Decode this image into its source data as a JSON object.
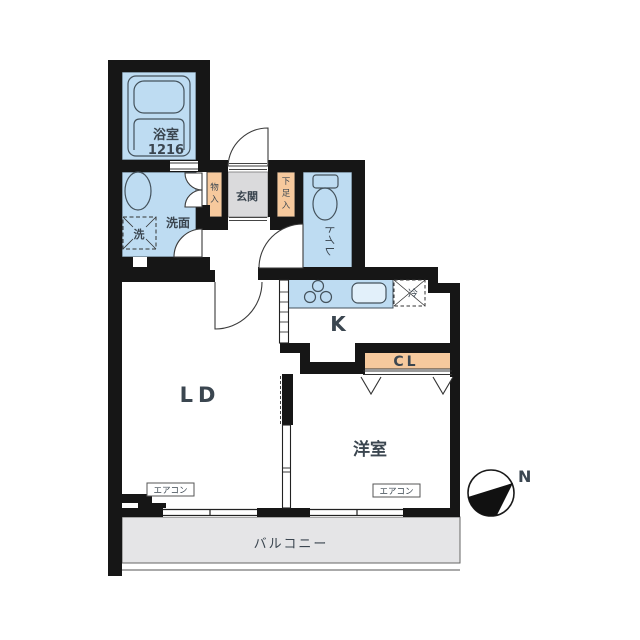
{
  "plan": {
    "bathroom_label": "浴室",
    "bathroom_size": "1216",
    "washroom_label": "洗面",
    "washer_label": "洗",
    "entrance_label": "玄関",
    "storage_chars": [
      "物",
      "入"
    ],
    "shoe_chars": [
      "下",
      "足",
      "入"
    ],
    "toilet_label": "トイレ",
    "kitchen_label": "K",
    "fridge_label": "冷",
    "living_label": "LD",
    "closet_label": "CL",
    "bedroom_label": "洋室",
    "aircon_label": "エアコン",
    "balcony_label": "バルコニー",
    "compass_label": "N",
    "colors": {
      "wet_area": "#bedcf2",
      "storage": "#f6c99d",
      "entrance": "#dadadc",
      "balcony": "#e5e5e7",
      "wall": "#161616",
      "closet_text": "#b06f2b",
      "balcony_text": "#8d9297"
    }
  }
}
